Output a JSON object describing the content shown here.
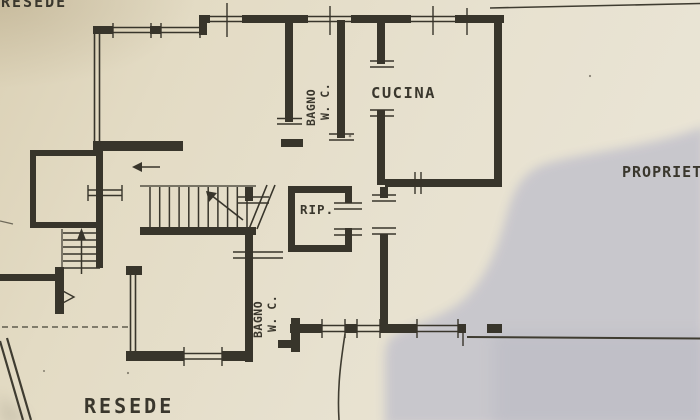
{
  "scene": {
    "description": "Photographed architectural floor plan sheet with shadow over right portion",
    "colors": {
      "paper": "#e6dfcc",
      "paper_dark": "#dbd1b6",
      "ink": "#38352b",
      "shadow": "#c6c5cc",
      "text_ink": "#3a372d"
    }
  },
  "labels": {
    "resede_top": "RESEDE",
    "resede_bottom": "RESEDE",
    "proprieta": "PROPRIETA",
    "cucina": "CUCINA",
    "rip": "RIP.",
    "bagno1_line1": "BAGNO",
    "bagno1_line2": "W. C.",
    "bagno2_line1": "BAGNO",
    "bagno2_line2": "W. C."
  },
  "rooms": [
    "CUCINA",
    "BAGNO W.C.",
    "RIP.",
    "BAGNO W.C."
  ],
  "outdoor_areas": [
    "RESEDE",
    "RESEDE",
    "PROPRIETA"
  ]
}
